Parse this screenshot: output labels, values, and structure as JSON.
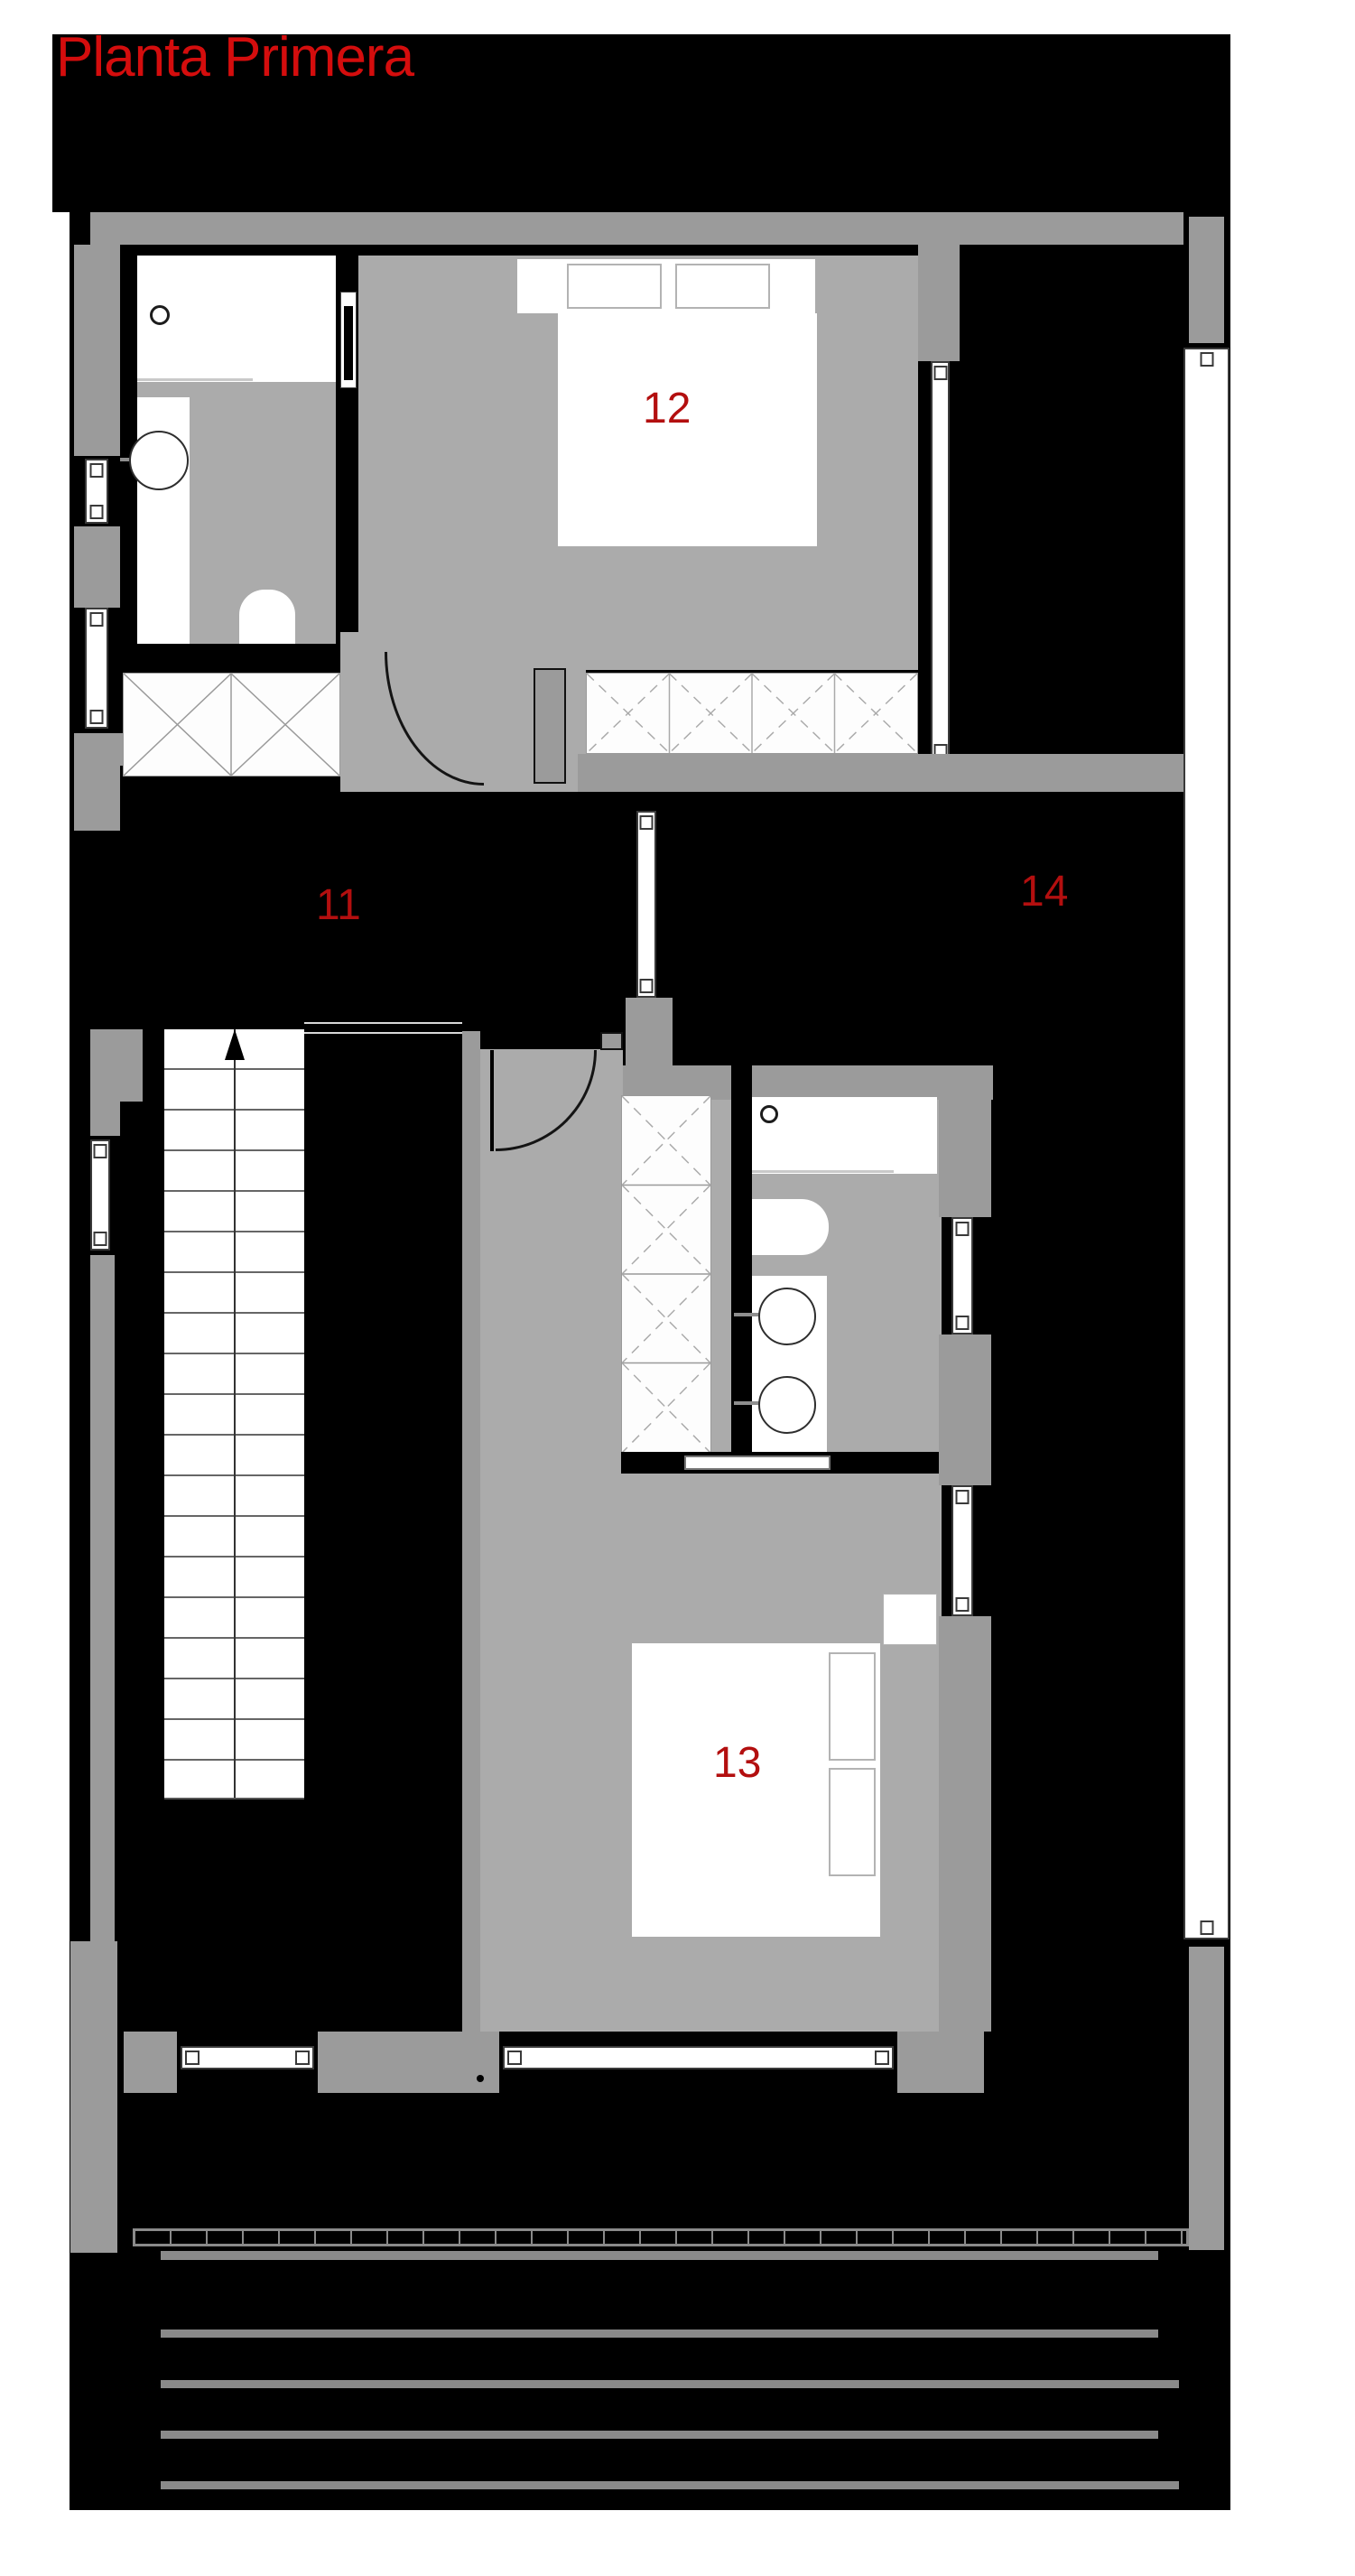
{
  "title": "Planta Primera",
  "rooms": [
    {
      "id": "hall",
      "number": "11"
    },
    {
      "id": "bedroom-12",
      "number": "12"
    },
    {
      "id": "bedroom-13",
      "number": "13"
    },
    {
      "id": "space-14",
      "number": "14"
    }
  ],
  "colors": {
    "page": "#ffffff",
    "background": "#000000",
    "wall": "#9b9b9b",
    "floor": "#ababab",
    "fixture": "#ffffff",
    "accent_title": "#d40d0d",
    "accent_room": "#b30f0f"
  }
}
